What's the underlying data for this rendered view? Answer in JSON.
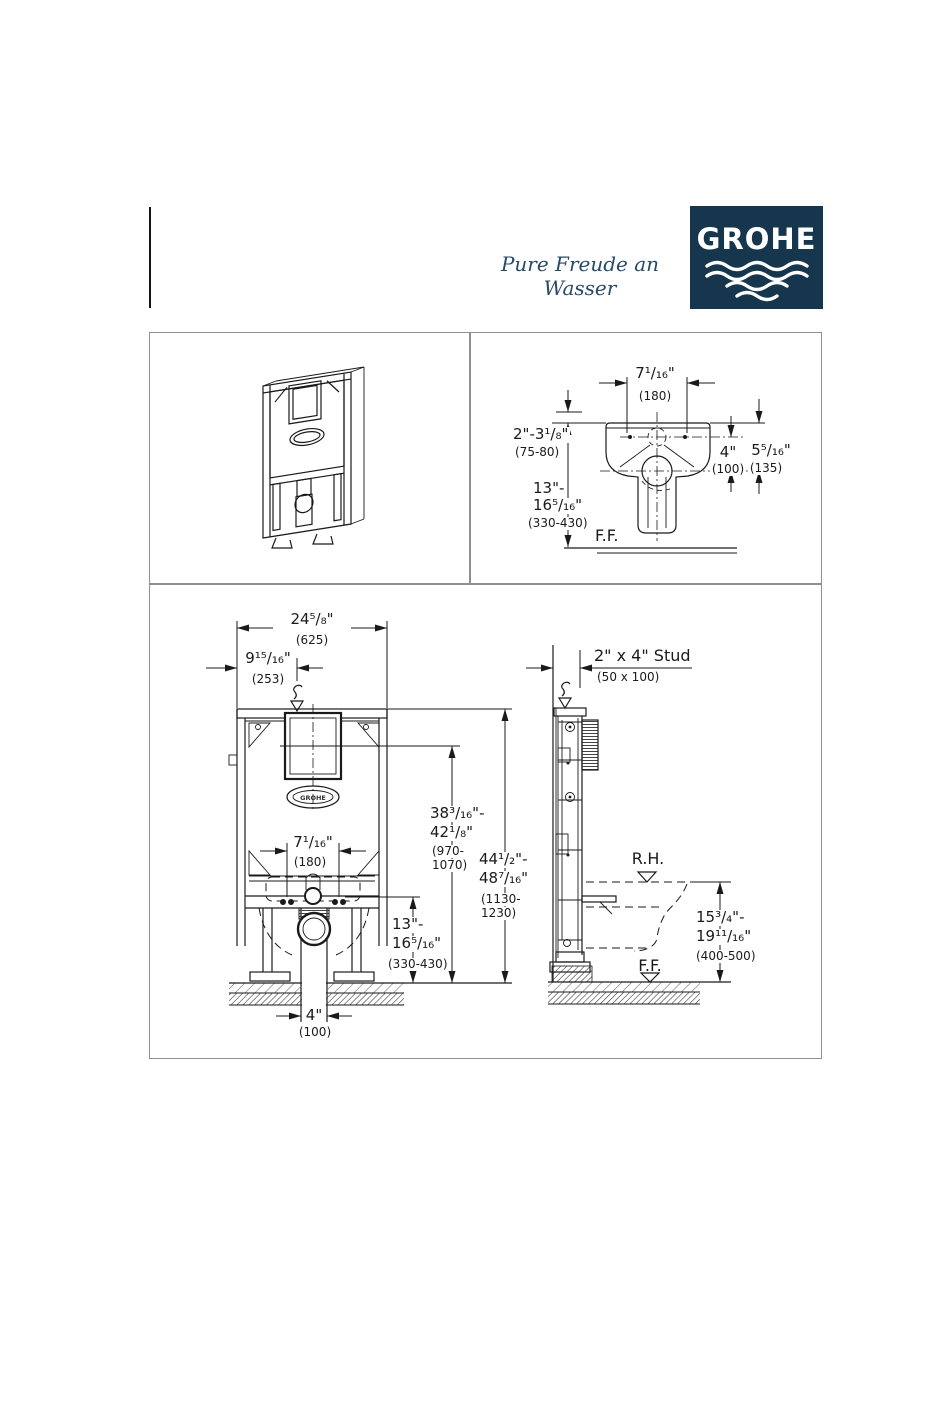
{
  "header": {
    "tagline": "Pure Freude an Wasser",
    "logo_text": "GROHE",
    "logo_bg": "#16364d"
  },
  "top_view": {
    "dim_cc": {
      "in": "7¹/₁₆\"",
      "mm": "(180)"
    },
    "dim_wall": {
      "in": "2\"-3¹/₈\"",
      "mm": "(75-80)"
    },
    "dim_supply_height": {
      "l1": "13\"-",
      "l2": "16⁵/₁₆\"",
      "mm": "(330-430)"
    },
    "dim_offset": {
      "in": "4\"",
      "mm": "(100)"
    },
    "dim_rim": {
      "in": "5⁵/₁₆\"",
      "mm": "(135)"
    },
    "floor_label": "F.F."
  },
  "front_view": {
    "tank_logo": "GROHE",
    "dim_width": {
      "in": "24⁵/₈\"",
      "mm": "(625)"
    },
    "dim_supply_offset": {
      "in": "9¹⁵/₁₆\"",
      "mm": "(253)"
    },
    "dim_bolt_spacing": {
      "in": "7¹/₁₆\"",
      "mm": "(180)"
    },
    "dim_actuator_height": {
      "l1": "38³/₁₆\"-",
      "l2": "42¹/₈\"",
      "m1": "(970-",
      "m2": "1070)"
    },
    "dim_frame_height": {
      "l1": "44¹/₂\"-",
      "l2": "48⁷/₁₆\"",
      "m1": "(1130-",
      "m2": "1230)"
    },
    "dim_outlet_height": {
      "l1": "13\"-",
      "l2": "16⁵/₁₆\"",
      "mm": "(330-430)"
    },
    "dim_outlet_width": {
      "in": "4\"",
      "mm": "(100)"
    }
  },
  "side_view": {
    "stud_label": "2\" x 4\" Stud",
    "stud_mm": "(50 x 100)",
    "rim_label": "R.H.",
    "floor_label": "F.F.",
    "dim_rim_height": {
      "l1": "15³/₄\"-",
      "l2": "19¹¹/₁₆\"",
      "mm": "(400-500)"
    }
  }
}
